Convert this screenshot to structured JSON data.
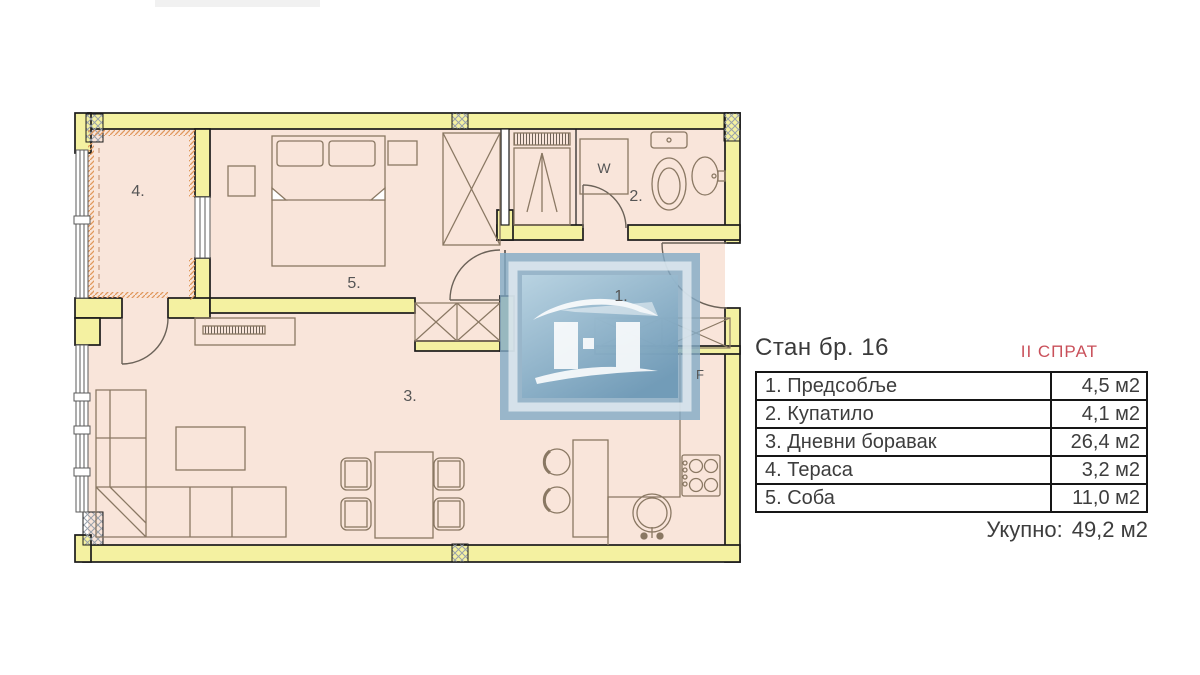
{
  "colors": {
    "wall": "#f4f1a1",
    "floor": "#f9e5da",
    "outline": "#1b1b1b",
    "furniture": "#8a7863",
    "hatch": "#99a1ab",
    "orange": "#e0975c",
    "red": "#c9505a",
    "text": "#3d3d3d",
    "window": "#5a5a5a"
  },
  "plan": {
    "room_labels": {
      "hall": "1.",
      "bathroom": "2.",
      "living": "3.",
      "terrace": "4.",
      "bedroom": "5."
    },
    "appliance_labels": {
      "washing_machine": "W",
      "fridge": "F"
    }
  },
  "panel": {
    "title": "Стан бр. 16",
    "floor_badge": "II СПРАТ",
    "table": {
      "rows": [
        {
          "name": "1. Предсобље",
          "area": "4,5 м2"
        },
        {
          "name": "2. Купатило",
          "area": "4,1 м2"
        },
        {
          "name": "3. Дневни боравак",
          "area": "26,4 м2"
        },
        {
          "name": "4. Тераса",
          "area": "3,2 м2"
        },
        {
          "name": "5. Соба",
          "area": "11,0 м2"
        }
      ]
    },
    "total": {
      "label": "Укупно:",
      "value": "49,2 м2"
    }
  }
}
